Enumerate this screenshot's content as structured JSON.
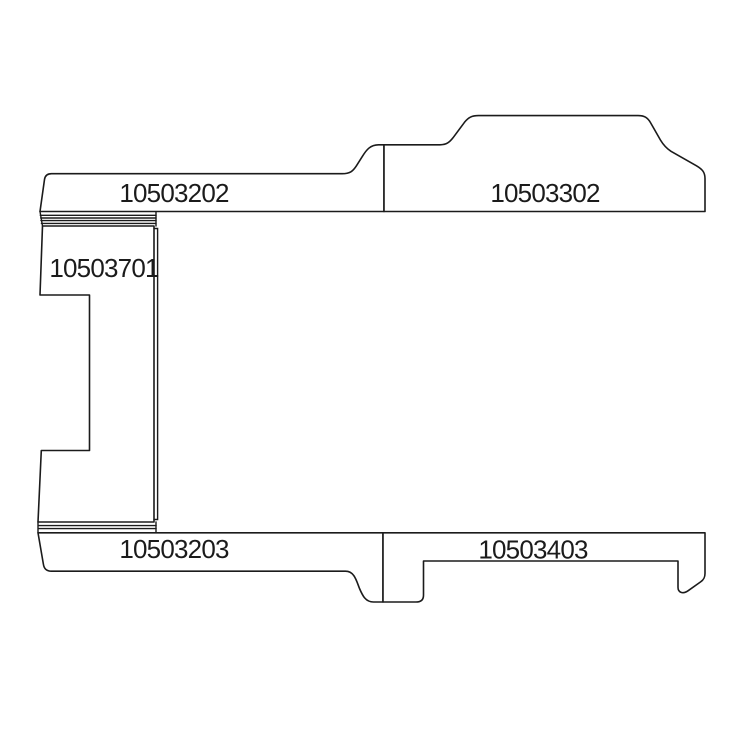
{
  "page": {
    "background_color": "#ffffff"
  },
  "diagram": {
    "line_color": "#1b1b1b",
    "parts": [
      {
        "label": "10503202",
        "position": "top-left-strip"
      },
      {
        "label": "10503302",
        "position": "top-right-strip"
      },
      {
        "label": "10503701",
        "position": "left-side-panel"
      },
      {
        "label": "10503203",
        "position": "bottom-left-strip"
      },
      {
        "label": "10503403",
        "position": "bottom-right-strip"
      }
    ]
  }
}
